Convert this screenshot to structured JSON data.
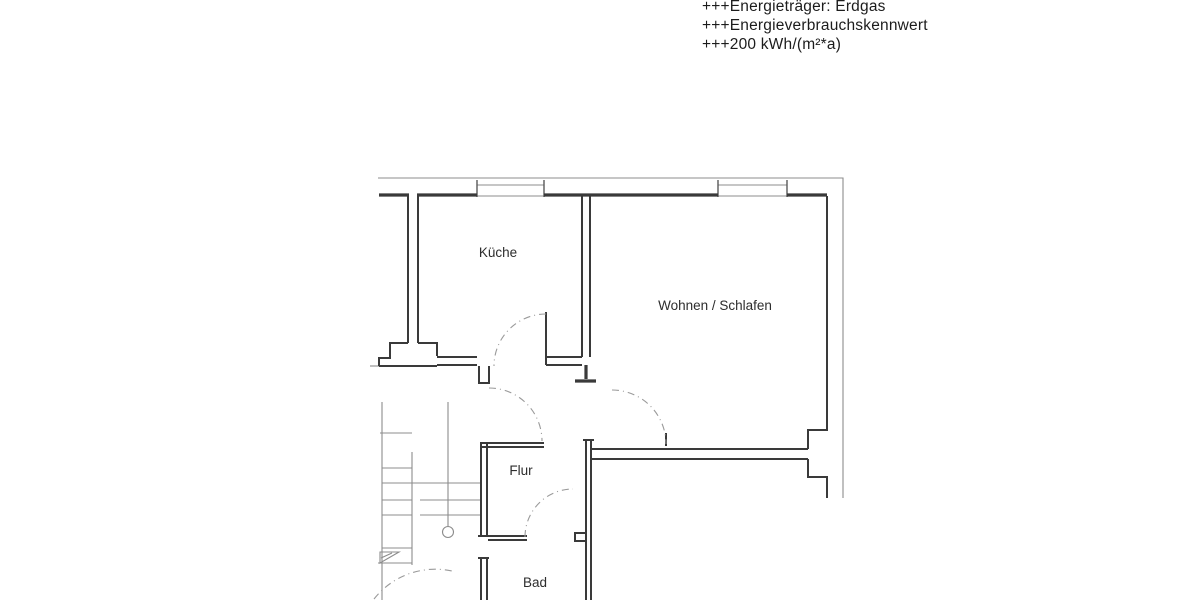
{
  "energy_info": {
    "line1": "+++Energieträger: Erdgas",
    "line2": "+++Energieverbrauchskennwert",
    "line3": "+++200 kWh/(m²*a)"
  },
  "floor_plan": {
    "rooms": {
      "kitchen": "Küche",
      "living": "Wohnen / Schlafen",
      "hallway": "Flur",
      "bathroom": "Bad"
    },
    "colors": {
      "background": "#ffffff",
      "wall": "#3a3a3a",
      "thin_line": "#8c8c8c",
      "door_arc": "#9a9a9a",
      "label_text": "#2d2d2d",
      "header_text": "#1c1c1c"
    }
  }
}
